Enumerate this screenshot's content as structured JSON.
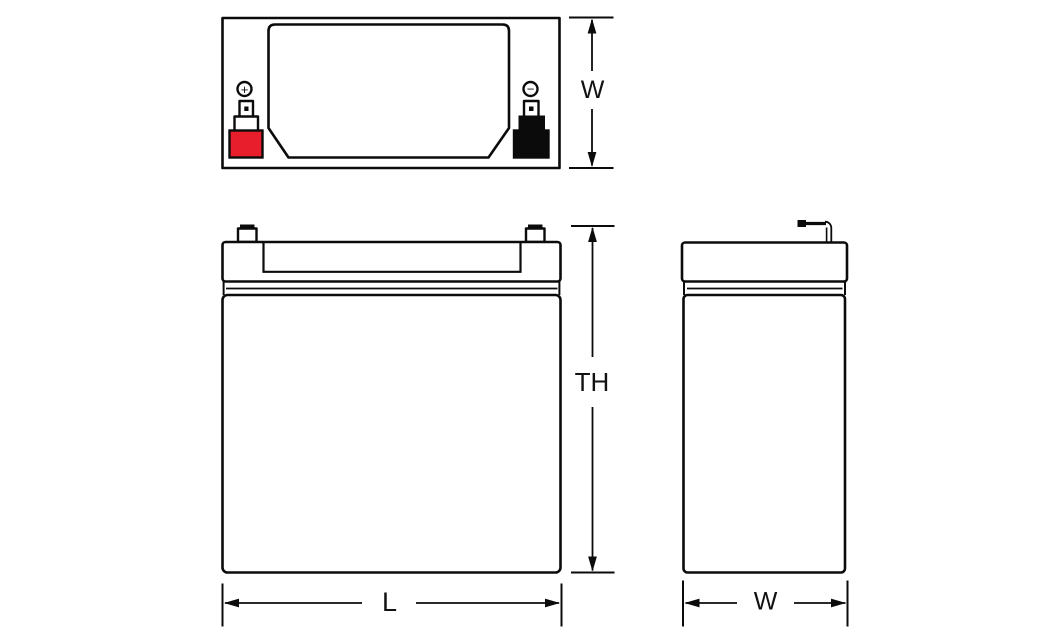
{
  "views": {
    "top": {
      "positive_symbol": "+",
      "negative_symbol": "−"
    }
  },
  "dimensions": {
    "top_width": "W",
    "total_height": "TH",
    "length": "L",
    "side_width": "W"
  },
  "colors": {
    "positive_terminal": "#e81e2c",
    "negative_terminal": "#0b0b0b",
    "line": "#0b0b0b"
  }
}
